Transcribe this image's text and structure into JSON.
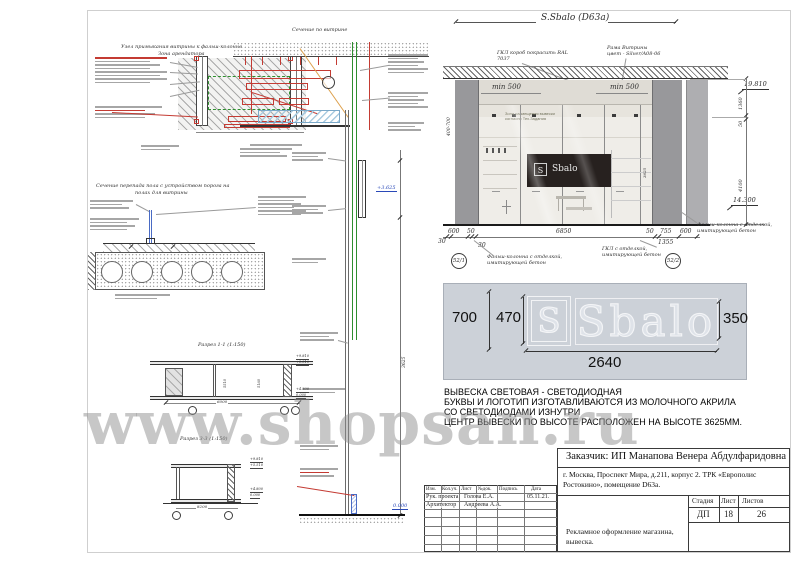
{
  "watermark": "www.shopsan.ru",
  "left": {
    "nodeTitle1": "Узел примыкания витрины к фальш-колонне",
    "nodeTitle2": "Зона арендатора",
    "secTitle": "Сечение по витрине",
    "signLevel": "+3.625",
    "floorLevel": "0.000",
    "floorTitle1": "Сечение перепада пола с устройством порога на",
    "floorTitle2": "полах для витрины",
    "r11": "Разрез 1-1 (1:150)",
    "r33": "Разрез 3-3 (1:150)",
    "r11w": "6000",
    "r33w": "8200",
    "dimV1": "5510",
    "dimV2": "5160",
    "dim3625": "3625",
    "lvlA": "+9.810",
    "lvlB": "+5.510",
    "lvlC": "+4.800",
    "lvlD": "0.000"
  },
  "elev": {
    "title": "S.Sbalo (D63a)",
    "noteGkl1": "ГКЛ короб покрасить RAL",
    "noteGkl2": "7037",
    "noteFrame1": "Рама Витрины",
    "noteFrame2": "цвет - Silver/A08-06",
    "minL": "min 500",
    "minR": "min 500",
    "zone1": "Зона размещения вывески",
    "zone2": "согласно Тех.Задания",
    "range": "400-700",
    "storeS": "S",
    "storeName": "Sbalo",
    "lvlTop": "19.810",
    "lvlBot": "14.300",
    "rd1": "1360",
    "rd2": "50",
    "rd3": "4100",
    "b600a": "600",
    "b50a": "50",
    "b6850": "6850",
    "b50b": "50",
    "b755": "755",
    "b600b": "600",
    "b30a": "30",
    "b30b": "30",
    "b1355": "1355",
    "c1": "52/1",
    "c2": "52/2",
    "labL1": "Фальш-колонна с отделкой,",
    "labL2": "имитирующей бетон",
    "labM1": "ГКЛ с отделкой,",
    "labM2": "имитирующей бетон",
    "labR1": "Фальш-колонна с отделкой,",
    "labR2": "имитирующей бетон"
  },
  "sign": {
    "s": "S",
    "name": "Sbalo",
    "d700": "700",
    "d470": "470",
    "d350": "350",
    "d2640": "2640"
  },
  "desc": {
    "l1": "ВЫВЕСКА СВЕТОВАЯ - СВЕТОДИОДНАЯ",
    "l2": "БУКВЫ И ЛОГОТИП ИЗГОТАВЛИВАЮТСЯ ИЗ МОЛОЧНОГО АКРИЛА",
    "l3": "СО СВЕТОДИОДАМИ ИЗНУТРИ",
    "l4": "ЦЕНТР ВЫВЕСКИ ПО ВЫСОТЕ РАСПОЛОЖЕН НА ВЫСОТЕ 3625ММ."
  },
  "tb": {
    "customer": "Заказчик:  ИП Манапова Венера Абдулфаридовна",
    "addr1": "г. Москва, Проспект Мира, д.211, корпус 2. ТРК «Европолис",
    "addr2": "Ростокино», помещение D63a.",
    "h1": "Изм.",
    "h2": "Кол.уч.",
    "h3": "Лист",
    "h4": "№док.",
    "h5": "Подпись",
    "h6": "Дата",
    "r1a": "Рук. проекта",
    "r1b": "Голова Е.А.",
    "r1d": "05.11.21.",
    "r2a": "Архитектор",
    "r2b": "Андреева А.А.",
    "sh": "Стадия",
    "lh": "Лист",
    "lsh": "Листов",
    "sv": "ДП",
    "lv": "18",
    "lsv": "26",
    "p1": "Рекламное оформление магазина,",
    "p2": "вывеска."
  }
}
